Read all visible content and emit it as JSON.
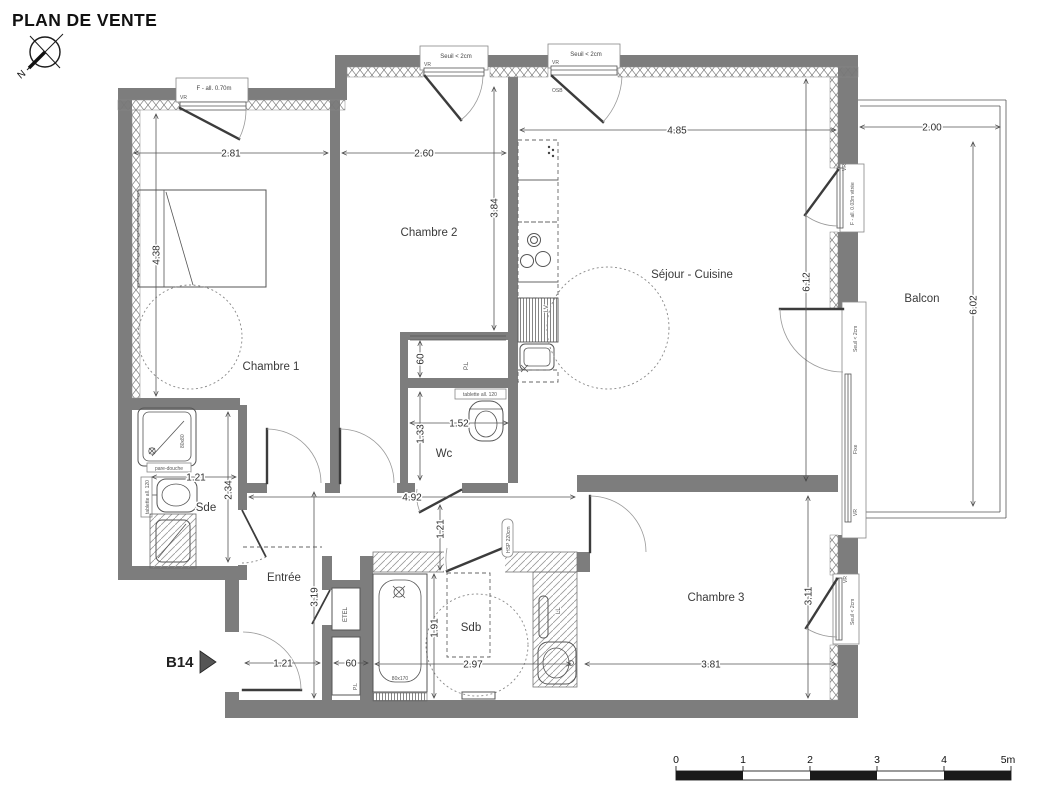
{
  "title": "PLAN DE VENTE",
  "unit_id": "B14",
  "compass": {
    "north": "N"
  },
  "rooms": {
    "chambre1": "Chambre 1",
    "chambre2": "Chambre 2",
    "sejour": "Séjour - Cuisine",
    "balcon": "Balcon",
    "wc": "Wc",
    "sde": "Sde",
    "entree": "Entrée",
    "sdb": "Sdb",
    "chambre3": "Chambre 3"
  },
  "dims": {
    "chambre1_w": "2.81",
    "chambre1_h": "4.38",
    "chambre2_w": "2.60",
    "chambre2_h": "3.84",
    "sejour_w": "4.85",
    "sejour_h": "6.12",
    "balcon_w": "2.00",
    "balcon_h": "6.02",
    "hall_l": "4.92",
    "hall_w": "1.21",
    "wc_w": "1.52",
    "wc_h": "1.33",
    "pl_depth": "60",
    "sde_w": "1.21",
    "sde_h": "2.34",
    "entree_w": "1.21",
    "entree_h": "3.19",
    "etel_w": "60",
    "sdb_w": "2.97",
    "sdb_h": "1.91",
    "chambre3_w": "3.81",
    "chambre3_h": "3.11"
  },
  "openings": {
    "vr": "VR",
    "seuil": "Seuil < 2cm",
    "osb": "OSB",
    "fixe": "Fixe",
    "f_all_070": "F - all. 0.70m",
    "f_all_003": "F - all. 0.03m vitrée"
  },
  "fixtures": {
    "tablette": "tablette all. 120",
    "pare_douche": "pare-douche",
    "shower_size": "80x80",
    "tub_size": "80x170",
    "lave_vaisselle": "LV",
    "lave_linge": "LL",
    "etel": "ETEL",
    "placard": "P.L",
    "hsp": "HSP 220cm"
  },
  "scale_bar": {
    "ticks": [
      "0",
      "1",
      "2",
      "3",
      "4",
      "5m"
    ]
  }
}
